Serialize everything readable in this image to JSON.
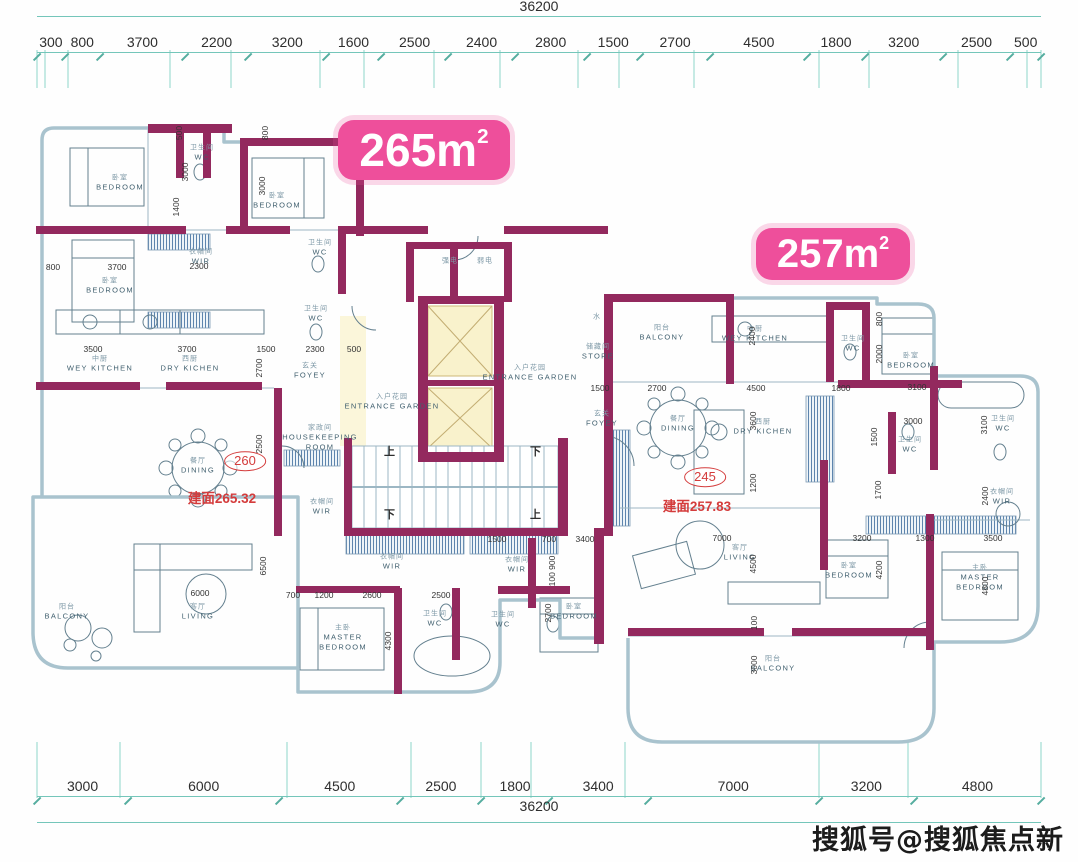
{
  "page": {
    "watermark": "搜狐号@搜狐焦点新余站"
  },
  "badges": {
    "left": {
      "text": "265m",
      "sup": "2"
    },
    "right": {
      "text": "257m",
      "sup": "2"
    }
  },
  "dims_top": {
    "total": "36200",
    "segments": [
      "300",
      "800",
      "3700",
      "2200",
      "3200",
      "1600",
      "2500",
      "2400",
      "2800",
      "1500",
      "2700",
      "4500",
      "1800",
      "3200",
      "2500",
      "500"
    ]
  },
  "dims_bottom": {
    "total": "36200",
    "segments": [
      "3000",
      "6000",
      "4500",
      "2500",
      "1800",
      "3400",
      "7000",
      "3200",
      "4800"
    ]
  },
  "annotations": {
    "left_no": "260",
    "left_area": "建面265.32",
    "right_no": "245",
    "right_area": "建面257.83"
  },
  "rooms": [
    {
      "cn": "卧室",
      "en": "BEDROOM",
      "x": 120,
      "y": 183
    },
    {
      "cn": "卧室",
      "en": "BEDROOM",
      "x": 110,
      "y": 286
    },
    {
      "cn": "卧室",
      "en": "BEDROOM",
      "x": 277,
      "y": 201
    },
    {
      "cn": "卫生间",
      "en": "WC",
      "x": 202,
      "y": 153
    },
    {
      "cn": "衣帽间",
      "en": "WIR",
      "x": 201,
      "y": 257
    },
    {
      "cn": "卫生间",
      "en": "WC",
      "x": 320,
      "y": 248
    },
    {
      "cn": "卫生间",
      "en": "WC",
      "x": 316,
      "y": 314
    },
    {
      "cn": "中厨",
      "en": "WEY KITCHEN",
      "x": 100,
      "y": 364
    },
    {
      "cn": "西厨",
      "en": "DRY KICHEN",
      "x": 190,
      "y": 364
    },
    {
      "cn": "餐厅",
      "en": "DINING",
      "x": 198,
      "y": 466
    },
    {
      "cn": "玄关",
      "en": "FOYEY",
      "x": 310,
      "y": 371
    },
    {
      "cn": "入户花园",
      "en": "ENTRANCE GARDEN",
      "x": 392,
      "y": 402
    },
    {
      "cn": "家政间",
      "en": "HOUSEKEEPING\nROOM",
      "x": 320,
      "y": 438
    },
    {
      "cn": "衣帽间",
      "en": "WIR",
      "x": 322,
      "y": 507
    },
    {
      "cn": "衣帽间",
      "en": "WIR",
      "x": 392,
      "y": 562
    },
    {
      "cn": "主卧",
      "en": "MASTER\nBEDROOM",
      "x": 343,
      "y": 638
    },
    {
      "cn": "卫生间",
      "en": "WC",
      "x": 435,
      "y": 619
    },
    {
      "cn": "卫生间",
      "en": "WC",
      "x": 503,
      "y": 620
    },
    {
      "cn": "卧室",
      "en": "BEDROOM",
      "x": 574,
      "y": 612
    },
    {
      "cn": "衣帽间",
      "en": "WIR",
      "x": 517,
      "y": 565
    },
    {
      "cn": "阳台",
      "en": "BALCONY",
      "x": 67,
      "y": 612
    },
    {
      "cn": "客厅",
      "en": "LIVING",
      "x": 198,
      "y": 612
    },
    {
      "cn": "阳台",
      "en": "BALCONY",
      "x": 662,
      "y": 333
    },
    {
      "cn": "中厨",
      "en": "WEY KITCHEN",
      "x": 755,
      "y": 334
    },
    {
      "cn": "卫生间",
      "en": "WC",
      "x": 853,
      "y": 344
    },
    {
      "cn": "餐厅",
      "en": "DINING",
      "x": 678,
      "y": 424
    },
    {
      "cn": "西厨",
      "en": "DRY KICHEN",
      "x": 763,
      "y": 427
    },
    {
      "cn": "玄关",
      "en": "FOYEY",
      "x": 602,
      "y": 419
    },
    {
      "cn": "入户花园",
      "en": "ENTRANCE GARDEN",
      "x": 530,
      "y": 373
    },
    {
      "cn": "储藏间",
      "en": "STORE",
      "x": 598,
      "y": 352
    },
    {
      "cn": "水",
      "en": "",
      "x": 597,
      "y": 317
    },
    {
      "cn": "强电",
      "en": "",
      "x": 450,
      "y": 261
    },
    {
      "cn": "弱电",
      "en": "",
      "x": 485,
      "y": 261
    },
    {
      "cn": "卧室",
      "en": "BEDROOM",
      "x": 911,
      "y": 361
    },
    {
      "cn": "卫生间",
      "en": "WC",
      "x": 1003,
      "y": 424
    },
    {
      "cn": "卫生间",
      "en": "WC",
      "x": 910,
      "y": 445
    },
    {
      "cn": "衣帽间",
      "en": "WIR",
      "x": 1002,
      "y": 497
    },
    {
      "cn": "客厅",
      "en": "LIVING",
      "x": 740,
      "y": 553
    },
    {
      "cn": "卧室",
      "en": "BEDROOM",
      "x": 849,
      "y": 571
    },
    {
      "cn": "主卧",
      "en": "MASTER\nBEDROOM",
      "x": 980,
      "y": 578
    },
    {
      "cn": "阳台",
      "en": "BALCONY",
      "x": 773,
      "y": 664
    },
    {
      "cn": "上",
      "en": "",
      "x": 390,
      "y": 452,
      "big": true
    },
    {
      "cn": "下",
      "en": "",
      "x": 390,
      "y": 515,
      "big": true
    },
    {
      "cn": "下",
      "en": "",
      "x": 536,
      "y": 452,
      "big": true
    },
    {
      "cn": "上",
      "en": "",
      "x": 536,
      "y": 515,
      "big": true
    }
  ],
  "plan_dims": [
    {
      "t": "800",
      "x": 53,
      "y": 267
    },
    {
      "t": "3700",
      "x": 117,
      "y": 267
    },
    {
      "t": "2300",
      "x": 199,
      "y": 266
    },
    {
      "t": "1400",
      "x": 176,
      "y": 207,
      "v": 1
    },
    {
      "t": "500",
      "x": 179,
      "y": 133,
      "v": 1
    },
    {
      "t": "3000",
      "x": 185,
      "y": 172,
      "v": 1
    },
    {
      "t": "3000",
      "x": 262,
      "y": 186,
      "v": 1
    },
    {
      "t": "800",
      "x": 265,
      "y": 133,
      "v": 1
    },
    {
      "t": "3500",
      "x": 93,
      "y": 349
    },
    {
      "t": "3700",
      "x": 187,
      "y": 349
    },
    {
      "t": "1500",
      "x": 266,
      "y": 349
    },
    {
      "t": "2300",
      "x": 315,
      "y": 349
    },
    {
      "t": "500",
      "x": 354,
      "y": 349
    },
    {
      "t": "2700",
      "x": 259,
      "y": 368,
      "v": 1
    },
    {
      "t": "2500",
      "x": 259,
      "y": 444,
      "v": 1
    },
    {
      "t": "6000",
      "x": 200,
      "y": 593
    },
    {
      "t": "6500",
      "x": 263,
      "y": 566,
      "v": 1
    },
    {
      "t": "700",
      "x": 293,
      "y": 595
    },
    {
      "t": "1200",
      "x": 324,
      "y": 595
    },
    {
      "t": "2600",
      "x": 372,
      "y": 595
    },
    {
      "t": "2500",
      "x": 441,
      "y": 595
    },
    {
      "t": "4300",
      "x": 388,
      "y": 641,
      "v": 1
    },
    {
      "t": "1500",
      "x": 497,
      "y": 539
    },
    {
      "t": "700",
      "x": 549,
      "y": 539
    },
    {
      "t": "3400",
      "x": 585,
      "y": 539
    },
    {
      "t": "100 900",
      "x": 552,
      "y": 571,
      "v": 1
    },
    {
      "t": "2700",
      "x": 548,
      "y": 613,
      "v": 1
    },
    {
      "t": "1500",
      "x": 600,
      "y": 388
    },
    {
      "t": "2700",
      "x": 657,
      "y": 388
    },
    {
      "t": "4500",
      "x": 756,
      "y": 388
    },
    {
      "t": "1800",
      "x": 841,
      "y": 388
    },
    {
      "t": "2400",
      "x": 752,
      "y": 336,
      "v": 1
    },
    {
      "t": "3600",
      "x": 753,
      "y": 421,
      "v": 1
    },
    {
      "t": "1200",
      "x": 753,
      "y": 483,
      "v": 1
    },
    {
      "t": "7000",
      "x": 722,
      "y": 538
    },
    {
      "t": "4500",
      "x": 753,
      "y": 564,
      "v": 1
    },
    {
      "t": "100",
      "x": 754,
      "y": 623,
      "v": 1
    },
    {
      "t": "3000",
      "x": 754,
      "y": 665,
      "v": 1
    },
    {
      "t": "800",
      "x": 879,
      "y": 319,
      "v": 1
    },
    {
      "t": "2000",
      "x": 879,
      "y": 354,
      "v": 1
    },
    {
      "t": "3100",
      "x": 917,
      "y": 387
    },
    {
      "t": "1500",
      "x": 874,
      "y": 437,
      "v": 1
    },
    {
      "t": "1700",
      "x": 878,
      "y": 490,
      "v": 1
    },
    {
      "t": "3000",
      "x": 913,
      "y": 421
    },
    {
      "t": "3100",
      "x": 984,
      "y": 425,
      "v": 1
    },
    {
      "t": "2400",
      "x": 985,
      "y": 496,
      "v": 1
    },
    {
      "t": "3200",
      "x": 862,
      "y": 538
    },
    {
      "t": "1300",
      "x": 925,
      "y": 538
    },
    {
      "t": "3500",
      "x": 993,
      "y": 538
    },
    {
      "t": "4200",
      "x": 879,
      "y": 570,
      "v": 1
    },
    {
      "t": "4800",
      "x": 985,
      "y": 586,
      "v": 1
    }
  ]
}
